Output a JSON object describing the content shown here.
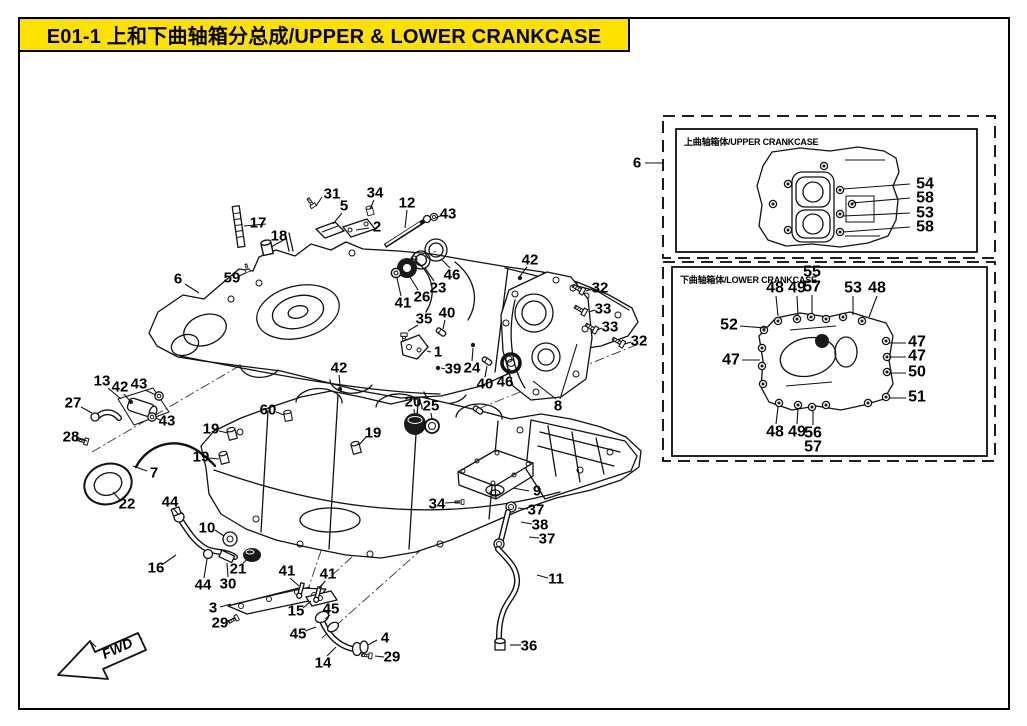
{
  "header": {
    "title": "E01-1  上和下曲轴箱分总成/UPPER & LOWER CRANKCASE"
  },
  "colors": {
    "header_bg": "#ffe100",
    "line": "#111111"
  },
  "insets": {
    "upper_label": "上曲轴箱体/UPPER CRANKCASE",
    "lower_label": "下曲轴箱体/LOWER CRANKCASE"
  },
  "fwd_label": "FWD",
  "callouts": [
    {
      "t": "31",
      "x": 332,
      "y": 194,
      "lines": [
        [
          322,
          197,
          316,
          206
        ]
      ]
    },
    {
      "t": "34",
      "x": 375,
      "y": 193,
      "lines": [
        [
          374,
          200,
          370,
          209
        ]
      ]
    },
    {
      "t": "12",
      "x": 407,
      "y": 203,
      "lines": [
        [
          407,
          210,
          405,
          228
        ]
      ]
    },
    {
      "t": "43",
      "x": 448,
      "y": 214,
      "lines": [
        [
          440,
          216,
          436,
          218
        ]
      ]
    },
    {
      "t": "5",
      "x": 344,
      "y": 206,
      "lines": [
        [
          342,
          213,
          333,
          224
        ]
      ]
    },
    {
      "t": "2",
      "x": 377,
      "y": 227,
      "lines": [
        [
          369,
          228,
          356,
          230
        ]
      ]
    },
    {
      "t": "17",
      "x": 258,
      "y": 223,
      "lines": [
        [
          266,
          224,
          244,
          226
        ]
      ]
    },
    {
      "t": "18",
      "x": 279,
      "y": 236,
      "lines": [
        [
          287,
          238,
          271,
          247
        ]
      ]
    },
    {
      "t": "59",
      "x": 232,
      "y": 278,
      "lines": [
        [
          239,
          276,
          246,
          273
        ]
      ]
    },
    {
      "t": "6",
      "x": 178,
      "y": 279,
      "lines": [
        [
          185,
          284,
          199,
          293
        ]
      ]
    },
    {
      "t": "46",
      "x": 452,
      "y": 275,
      "lines": [
        [
          450,
          268,
          441,
          259
        ]
      ]
    },
    {
      "t": "23",
      "x": 438,
      "y": 288,
      "lines": [
        [
          434,
          281,
          425,
          268
        ]
      ]
    },
    {
      "t": "26",
      "x": 422,
      "y": 297,
      "lines": [
        [
          418,
          290,
          410,
          277
        ]
      ]
    },
    {
      "t": "41",
      "x": 403,
      "y": 303,
      "lines": [
        [
          401,
          296,
          397,
          278
        ]
      ]
    },
    {
      "t": "35",
      "x": 424,
      "y": 319,
      "lines": [
        [
          418,
          325,
          408,
          331
        ]
      ]
    },
    {
      "t": "40",
      "x": 447,
      "y": 313,
      "lines": [
        [
          445,
          320,
          443,
          329
        ]
      ]
    },
    {
      "t": "1",
      "x": 438,
      "y": 352,
      "lines": [
        [
          431,
          352,
          427,
          351
        ]
      ]
    },
    {
      "t": "39",
      "x": 453,
      "y": 369,
      "lines": [
        [
          445,
          369,
          441,
          368
        ]
      ]
    },
    {
      "t": "24",
      "x": 472,
      "y": 368,
      "lines": [
        [
          472,
          361,
          473,
          348
        ]
      ]
    },
    {
      "t": "42",
      "x": 339,
      "y": 368,
      "lines": [
        [
          339,
          375,
          340,
          386
        ]
      ]
    },
    {
      "t": "40",
      "x": 485,
      "y": 384,
      "lines": [
        [
          485,
          377,
          487,
          366
        ]
      ]
    },
    {
      "t": "46",
      "x": 505,
      "y": 382,
      "lines": [
        [
          506,
          375,
          510,
          369
        ]
      ]
    },
    {
      "t": "20",
      "x": 413,
      "y": 402,
      "lines": [
        [
          414,
          409,
          415,
          416
        ]
      ]
    },
    {
      "t": "25",
      "x": 431,
      "y": 406,
      "lines": [
        [
          431,
          413,
          432,
          419
        ]
      ]
    },
    {
      "t": "19",
      "x": 373,
      "y": 433,
      "lines": [
        [
          366,
          437,
          359,
          445
        ]
      ]
    },
    {
      "t": "8",
      "x": 558,
      "y": 406,
      "lines": [
        [
          556,
          399,
          533,
          381
        ],
        [
          560,
          399,
          577,
          344
        ]
      ]
    },
    {
      "t": "42",
      "x": 530,
      "y": 260,
      "lines": [
        [
          527,
          267,
          520,
          276
        ]
      ]
    },
    {
      "t": "32",
      "x": 600,
      "y": 288,
      "lines": [
        [
          592,
          289,
          586,
          291
        ]
      ]
    },
    {
      "t": "33",
      "x": 603,
      "y": 309,
      "lines": [
        [
          595,
          310,
          589,
          312
        ]
      ]
    },
    {
      "t": "33",
      "x": 610,
      "y": 327,
      "lines": [
        [
          602,
          328,
          597,
          330
        ]
      ]
    },
    {
      "t": "32",
      "x": 639,
      "y": 341,
      "lines": [
        [
          631,
          342,
          625,
          344
        ]
      ]
    },
    {
      "t": "13",
      "x": 102,
      "y": 381,
      "lines": [
        [
          108,
          388,
          121,
          399
        ]
      ]
    },
    {
      "t": "42",
      "x": 120,
      "y": 387,
      "lines": [
        [
          124,
          394,
          130,
          401
        ]
      ]
    },
    {
      "t": "43",
      "x": 139,
      "y": 384,
      "lines": [
        [
          145,
          390,
          156,
          395
        ]
      ]
    },
    {
      "t": "27",
      "x": 73,
      "y": 403,
      "lines": [
        [
          81,
          407,
          92,
          413
        ]
      ]
    },
    {
      "t": "43",
      "x": 167,
      "y": 421,
      "lines": [
        [
          160,
          420,
          156,
          418
        ]
      ]
    },
    {
      "t": "28",
      "x": 71,
      "y": 437,
      "lines": [
        [
          79,
          439,
          87,
          441
        ]
      ]
    },
    {
      "t": "7",
      "x": 154,
      "y": 473,
      "lines": [
        [
          147,
          471,
          133,
          466
        ]
      ]
    },
    {
      "t": "22",
      "x": 127,
      "y": 504,
      "lines": [
        [
          120,
          500,
          113,
          492
        ]
      ]
    },
    {
      "t": "60",
      "x": 268,
      "y": 410,
      "lines": [
        [
          276,
          412,
          284,
          415
        ]
      ]
    },
    {
      "t": "19",
      "x": 211,
      "y": 429,
      "lines": [
        [
          219,
          431,
          228,
          433
        ]
      ]
    },
    {
      "t": "19",
      "x": 201,
      "y": 457,
      "lines": [
        [
          209,
          458,
          219,
          459
        ]
      ]
    },
    {
      "t": "44",
      "x": 170,
      "y": 502,
      "lines": [
        [
          173,
          508,
          178,
          514
        ]
      ]
    },
    {
      "t": "10",
      "x": 207,
      "y": 528,
      "lines": [
        [
          215,
          530,
          224,
          536
        ]
      ]
    },
    {
      "t": "16",
      "x": 156,
      "y": 568,
      "lines": [
        [
          163,
          564,
          176,
          555
        ]
      ]
    },
    {
      "t": "44",
      "x": 203,
      "y": 585,
      "lines": [
        [
          204,
          578,
          207,
          559
        ]
      ]
    },
    {
      "t": "30",
      "x": 228,
      "y": 584,
      "lines": [
        [
          228,
          577,
          227,
          563
        ]
      ]
    },
    {
      "t": "21",
      "x": 238,
      "y": 569,
      "lines": [
        [
          243,
          563,
          249,
          558
        ]
      ]
    },
    {
      "t": "3",
      "x": 213,
      "y": 608,
      "lines": [
        [
          220,
          607,
          231,
          604
        ]
      ]
    },
    {
      "t": "29",
      "x": 220,
      "y": 623,
      "lines": [
        [
          227,
          621,
          236,
          618
        ]
      ]
    },
    {
      "t": "41",
      "x": 287,
      "y": 571,
      "lines": [
        [
          290,
          578,
          299,
          586
        ]
      ]
    },
    {
      "t": "41",
      "x": 328,
      "y": 574,
      "lines": [
        [
          325,
          581,
          319,
          589
        ]
      ]
    },
    {
      "t": "15",
      "x": 296,
      "y": 611,
      "lines": [
        [
          303,
          608,
          311,
          601
        ]
      ]
    },
    {
      "t": "45",
      "x": 331,
      "y": 609,
      "lines": [
        [
          330,
          615,
          325,
          619
        ]
      ]
    },
    {
      "t": "45",
      "x": 298,
      "y": 634,
      "lines": [
        [
          305,
          631,
          316,
          627
        ]
      ]
    },
    {
      "t": "14",
      "x": 323,
      "y": 663,
      "lines": [
        [
          327,
          656,
          336,
          647
        ]
      ]
    },
    {
      "t": "4",
      "x": 385,
      "y": 638,
      "lines": [
        [
          377,
          640,
          368,
          645
        ]
      ]
    },
    {
      "t": "29",
      "x": 392,
      "y": 657,
      "lines": [
        [
          384,
          657,
          375,
          656
        ]
      ]
    },
    {
      "t": "34",
      "x": 437,
      "y": 504,
      "lines": [
        [
          445,
          503,
          460,
          502
        ]
      ]
    },
    {
      "t": "9",
      "x": 537,
      "y": 491,
      "lines": [
        [
          529,
          491,
          513,
          488
        ]
      ]
    },
    {
      "t": "37",
      "x": 536,
      "y": 510,
      "lines": [
        [
          528,
          509,
          518,
          508
        ]
      ]
    },
    {
      "t": "38",
      "x": 540,
      "y": 525,
      "lines": [
        [
          532,
          524,
          521,
          522
        ]
      ]
    },
    {
      "t": "37",
      "x": 547,
      "y": 539,
      "lines": [
        [
          539,
          538,
          529,
          537
        ]
      ]
    },
    {
      "t": "11",
      "x": 556,
      "y": 579,
      "lines": [
        [
          548,
          578,
          537,
          575
        ]
      ]
    },
    {
      "t": "36",
      "x": 529,
      "y": 646,
      "lines": [
        [
          521,
          645,
          510,
          645
        ]
      ]
    },
    {
      "t": "6",
      "x": 637,
      "y": 163,
      "lines": [
        [
          645,
          163,
          663,
          163
        ]
      ]
    },
    {
      "t": "54",
      "x": 925,
      "y": 184,
      "fs": 16,
      "lines": [
        [
          910,
          184,
          843,
          189
        ]
      ]
    },
    {
      "t": "58",
      "x": 925,
      "y": 198,
      "fs": 16,
      "lines": [
        [
          910,
          198,
          852,
          203
        ]
      ]
    },
    {
      "t": "53",
      "x": 925,
      "y": 213,
      "fs": 16,
      "lines": [
        [
          910,
          213,
          843,
          216
        ]
      ]
    },
    {
      "t": "58",
      "x": 925,
      "y": 227,
      "fs": 16,
      "lines": [
        [
          910,
          227,
          843,
          232
        ]
      ]
    },
    {
      "t": "48",
      "x": 775,
      "y": 288,
      "fs": 16,
      "lines": [
        [
          776,
          296,
          778,
          316
        ]
      ]
    },
    {
      "t": "49",
      "x": 797,
      "y": 288,
      "fs": 16,
      "lines": [
        [
          797,
          296,
          798,
          316
        ]
      ]
    },
    {
      "t": "55",
      "x": 812,
      "y": 272,
      "fs": 16
    },
    {
      "t": "57",
      "x": 812,
      "y": 287,
      "fs": 16,
      "lines": [
        [
          812,
          295,
          812,
          313
        ]
      ]
    },
    {
      "t": "53",
      "x": 853,
      "y": 288,
      "fs": 16,
      "lines": [
        [
          853,
          296,
          853,
          315
        ]
      ]
    },
    {
      "t": "48",
      "x": 877,
      "y": 288,
      "fs": 16,
      "lines": [
        [
          877,
          296,
          869,
          317
        ]
      ]
    },
    {
      "t": "52",
      "x": 729,
      "y": 325,
      "fs": 16,
      "lines": [
        [
          740,
          326,
          766,
          328
        ]
      ]
    },
    {
      "t": "47",
      "x": 731,
      "y": 360,
      "fs": 16,
      "lines": [
        [
          742,
          360,
          760,
          360
        ]
      ]
    },
    {
      "t": "47",
      "x": 917,
      "y": 342,
      "fs": 16,
      "lines": [
        [
          906,
          343,
          889,
          343
        ]
      ]
    },
    {
      "t": "47",
      "x": 917,
      "y": 356,
      "fs": 16,
      "lines": [
        [
          906,
          357,
          889,
          357
        ]
      ]
    },
    {
      "t": "50",
      "x": 917,
      "y": 372,
      "fs": 16,
      "lines": [
        [
          906,
          373,
          889,
          373
        ]
      ]
    },
    {
      "t": "51",
      "x": 917,
      "y": 397,
      "fs": 16,
      "lines": [
        [
          906,
          398,
          889,
          398
        ]
      ]
    },
    {
      "t": "48",
      "x": 775,
      "y": 432,
      "fs": 16,
      "lines": [
        [
          776,
          424,
          778,
          407
        ]
      ]
    },
    {
      "t": "49",
      "x": 797,
      "y": 432,
      "fs": 16,
      "lines": [
        [
          797,
          424,
          798,
          408
        ]
      ]
    },
    {
      "t": "56",
      "x": 813,
      "y": 433,
      "fs": 16,
      "lines": [
        [
          813,
          425,
          813,
          411
        ]
      ]
    },
    {
      "t": "57",
      "x": 813,
      "y": 447,
      "fs": 16
    }
  ]
}
